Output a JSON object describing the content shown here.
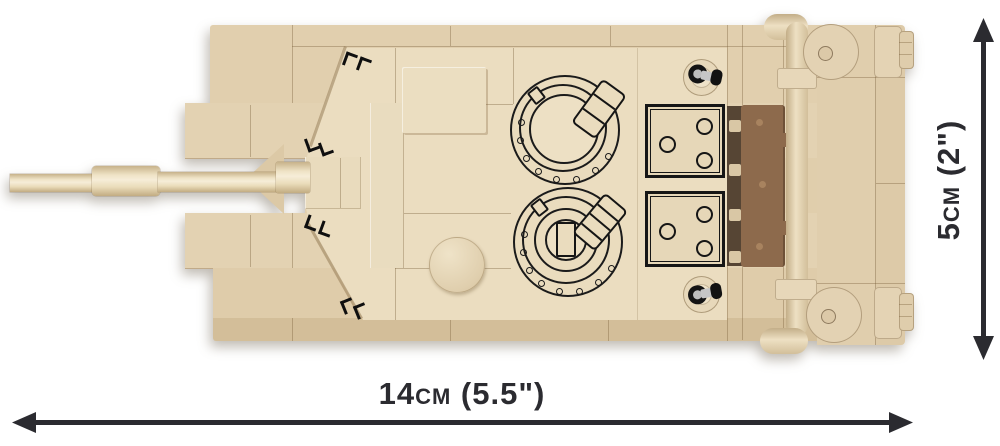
{
  "diagram": {
    "type": "product-dimension-diagram",
    "subject": "COBI brick-built tank model, top view with size dimensions",
    "dimensions": {
      "width": {
        "label": "14cm (5.5\")",
        "icon": "double-headed-horizontal-arrow-icon"
      },
      "height": {
        "label": "5cm (2\")",
        "icon": "double-headed-vertical-arrow-icon"
      }
    },
    "colors": {
      "background": "#ffffff",
      "brick_tan": "#e2d0af",
      "turret_tan_light": "#ebddc0",
      "hull_side_dark": "#d3bf9b",
      "stowage_rack_brown": "#8d6a4c",
      "print_outline_black": "#161616",
      "periscope_metal_gray": "#c6c6c6",
      "periscope_pin_black": "#141414",
      "dimension_ink": "#2b2b30"
    },
    "parts": [
      "gun-barrel",
      "bore-evacuator",
      "gun-mantlet",
      "mantlet-fan",
      "turret",
      "commander-hatch",
      "loader-hatch",
      "hatch-hinge",
      "vision-block-markings",
      "engine-deck-panel-1",
      "engine-deck-panel-2",
      "fuel-cap",
      "periscope-pin-front",
      "periscope-pin-rear",
      "stowage-rack",
      "tow-bar",
      "rear-plate",
      "rear-fender-top",
      "rear-fender-bottom",
      "hull-plates"
    ]
  }
}
